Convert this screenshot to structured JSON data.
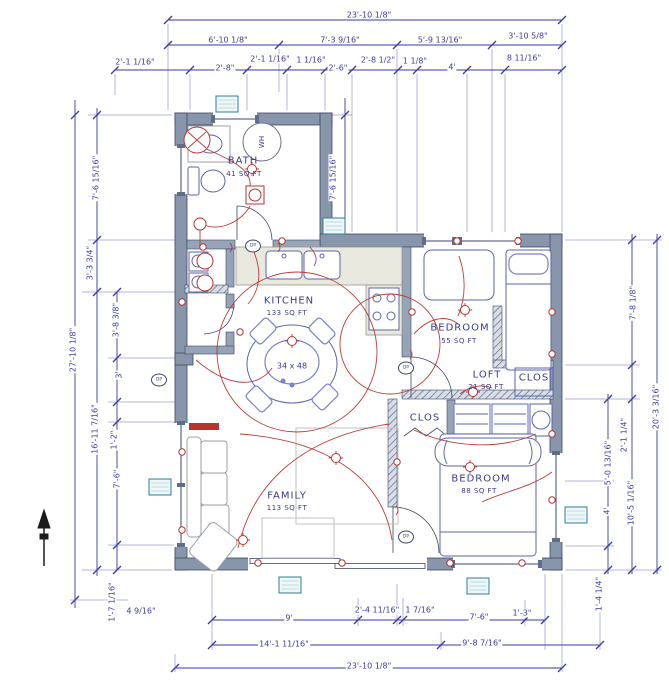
{
  "plan": {
    "rooms": [
      {
        "name": "BATH",
        "area": "41 SQ FT",
        "x": 243,
        "y": 161,
        "ax": 244,
        "ay": 174
      },
      {
        "name": "KITCHEN",
        "area": "133 SQ FT",
        "x": 289,
        "y": 301,
        "ax": 287,
        "ay": 313
      },
      {
        "name": "BEDROOM",
        "area": "55 SQ FT",
        "x": 460,
        "y": 328,
        "ax": 459,
        "ay": 341
      },
      {
        "name": "LOFT",
        "area": "21 SQ FT",
        "x": 487,
        "y": 375,
        "ax": 486,
        "ay": 387
      },
      {
        "name": "CLOS",
        "area": "",
        "x": 534,
        "y": 378,
        "ax": 534,
        "ay": 388
      },
      {
        "name": "CLOS",
        "area": "",
        "x": 425,
        "y": 418,
        "ax": 425,
        "ay": 428
      },
      {
        "name": "BEDROOM",
        "area": "88 SQ FT",
        "x": 481,
        "y": 479,
        "ax": 479,
        "ay": 491
      },
      {
        "name": "FAMILY",
        "area": "113 SQ FT",
        "x": 287,
        "y": 496,
        "ax": 287,
        "ay": 508
      }
    ],
    "fixtures": [
      {
        "label": "WH",
        "x": 262,
        "y": 142,
        "rot": -90
      },
      {
        "label": "34 x 48",
        "x": 292,
        "y": 366,
        "rot": 0
      }
    ],
    "markers": [
      {
        "label": "DP",
        "x": 253,
        "y": 246
      },
      {
        "label": "DP",
        "x": 159,
        "y": 380
      },
      {
        "label": "DP",
        "x": 406,
        "y": 368
      },
      {
        "label": "DP",
        "x": 406,
        "y": 537
      }
    ],
    "tags": [
      {
        "x": 227,
        "y": 104
      },
      {
        "x": 334,
        "y": 226
      },
      {
        "x": 160,
        "y": 487
      },
      {
        "x": 576,
        "y": 515
      },
      {
        "x": 290,
        "y": 585
      },
      {
        "x": 478,
        "y": 586
      }
    ],
    "dimensions": [
      {
        "t": "23'-10 1/8\"",
        "x": 369,
        "y": 15,
        "r": 0,
        "side": "top"
      },
      {
        "t": "6'-10 1/8\"",
        "x": 228,
        "y": 40,
        "r": 0,
        "side": "top"
      },
      {
        "t": "7'-3 9/16\"",
        "x": 340,
        "y": 40,
        "r": 0,
        "side": "top"
      },
      {
        "t": "5'-9 13/16\"",
        "x": 440,
        "y": 40,
        "r": 0,
        "side": "top"
      },
      {
        "t": "3'-10 5/8\"",
        "x": 528,
        "y": 36,
        "r": 0,
        "side": "top"
      },
      {
        "t": "8 11/16\"",
        "x": 524,
        "y": 58,
        "r": 0,
        "side": "top"
      },
      {
        "t": "2'-1 1/16\"",
        "x": 135,
        "y": 62,
        "r": 0,
        "side": "top"
      },
      {
        "t": "2'-8\"",
        "x": 225,
        "y": 68,
        "r": 0,
        "side": "top"
      },
      {
        "t": "2'-1 1/16\"",
        "x": 270,
        "y": 59,
        "r": 0,
        "side": "top"
      },
      {
        "t": "1 1/16\"",
        "x": 311,
        "y": 60,
        "r": 0,
        "side": "top"
      },
      {
        "t": "2'-6\"",
        "x": 338,
        "y": 68,
        "r": 0,
        "side": "top"
      },
      {
        "t": "2'-8 1/2\"",
        "x": 378,
        "y": 60,
        "r": 0,
        "side": "top"
      },
      {
        "t": "1 1/8\"",
        "x": 415,
        "y": 61,
        "r": 0,
        "side": "top"
      },
      {
        "t": "4'",
        "x": 452,
        "y": 67,
        "r": 0,
        "side": "top"
      },
      {
        "t": "27'-10 1/8\"",
        "x": 73,
        "y": 350,
        "r": -90,
        "side": "left"
      },
      {
        "t": "7'-6 15/16\"",
        "x": 96,
        "y": 178,
        "r": -90,
        "side": "left"
      },
      {
        "t": "3'-3 3/4\"",
        "x": 90,
        "y": 263,
        "r": -90,
        "side": "left"
      },
      {
        "t": "3'-8 3/8\"",
        "x": 116,
        "y": 320,
        "r": -90,
        "side": "left"
      },
      {
        "t": "3'",
        "x": 119,
        "y": 375,
        "r": -90,
        "side": "left"
      },
      {
        "t": "16'-11 7/16\"",
        "x": 95,
        "y": 429,
        "r": -90,
        "side": "left"
      },
      {
        "t": "1'-2\"",
        "x": 114,
        "y": 440,
        "r": -90,
        "side": "left"
      },
      {
        "t": "7'-6\"",
        "x": 117,
        "y": 479,
        "r": -90,
        "side": "left"
      },
      {
        "t": "1'-7 1/16\"",
        "x": 112,
        "y": 602,
        "r": -90,
        "side": "left"
      },
      {
        "t": "4 9/16\"",
        "x": 141,
        "y": 611,
        "r": 0,
        "side": "bottom"
      },
      {
        "t": "7'-6 15/16\"",
        "x": 333,
        "y": 178,
        "r": -90,
        "side": "interior"
      },
      {
        "t": "7'-8 1/8\"",
        "x": 633,
        "y": 303,
        "r": -90,
        "side": "right"
      },
      {
        "t": "2'-1 1/4\"",
        "x": 624,
        "y": 435,
        "r": -90,
        "side": "right"
      },
      {
        "t": "5'-0 13/16\"",
        "x": 608,
        "y": 463,
        "r": -90,
        "side": "right"
      },
      {
        "t": "4'",
        "x": 607,
        "y": 511,
        "r": -90,
        "side": "right"
      },
      {
        "t": "10'-5 1/16\"",
        "x": 631,
        "y": 503,
        "r": -90,
        "side": "right"
      },
      {
        "t": "20'-3 3/16\"",
        "x": 656,
        "y": 407,
        "r": -90,
        "side": "right"
      },
      {
        "t": "1'-4 1/4\"",
        "x": 599,
        "y": 594,
        "r": -90,
        "side": "right"
      },
      {
        "t": "9'",
        "x": 289,
        "y": 618,
        "r": 0,
        "side": "bottom"
      },
      {
        "t": "2'-4 11/16\"",
        "x": 377,
        "y": 610,
        "r": 0,
        "side": "bottom"
      },
      {
        "t": "1 7/16\"",
        "x": 420,
        "y": 610,
        "r": 0,
        "side": "bottom"
      },
      {
        "t": "7'-6\"",
        "x": 479,
        "y": 617,
        "r": 0,
        "side": "bottom"
      },
      {
        "t": "1'-3\"",
        "x": 522,
        "y": 613,
        "r": 0,
        "side": "bottom"
      },
      {
        "t": "14'-1 11/16\"",
        "x": 284,
        "y": 644,
        "r": 0,
        "side": "bottom"
      },
      {
        "t": "9'-8 7/16\"",
        "x": 482,
        "y": 643,
        "r": 0,
        "side": "bottom"
      },
      {
        "t": "23'-10 1/8\"",
        "x": 369,
        "y": 666,
        "r": 0,
        "side": "bottom"
      }
    ]
  },
  "colors": {
    "dimension": "#3a3aa0",
    "wall": "#8896ac",
    "electrical": "#b5352f",
    "furniture": "#5b66a8",
    "accent": "#7b82c8",
    "tag": "#2e7f93"
  }
}
